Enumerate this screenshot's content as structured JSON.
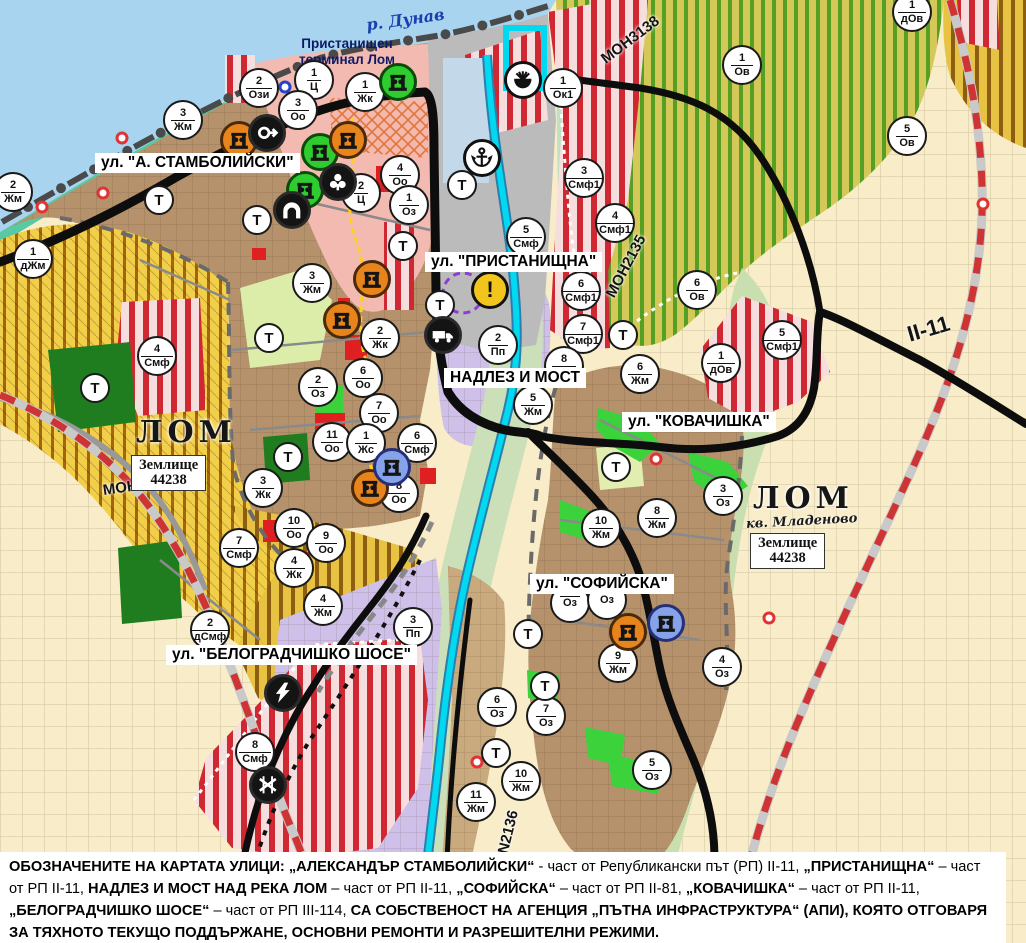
{
  "map": {
    "t_label": "Т",
    "exclamation_label": "!",
    "street_labels": [
      {
        "id": "stambolijski",
        "text": "ул. \"А. СТАМБОЛИЙСКИ\"",
        "x": 95,
        "y": 153
      },
      {
        "id": "pristanishtna",
        "text": "ул. \"ПРИСТАНИЩНА\"",
        "x": 425,
        "y": 252
      },
      {
        "id": "nadlez-i-most",
        "text": "НАДЛЕЗ И МОСТ",
        "x": 444,
        "y": 368
      },
      {
        "id": "kovachishka",
        "text": "ул. \"КОВАЧИШКА\"",
        "x": 622,
        "y": 412
      },
      {
        "id": "sofijska",
        "text": "ул. \"СОФИЙСКА\"",
        "x": 530,
        "y": 574
      },
      {
        "id": "belogradchishko",
        "text": "ул. \"БЕЛОГРАДЧИШКО ШОСЕ\"",
        "x": 166,
        "y": 645
      }
    ],
    "place_labels": [
      {
        "id": "river-danube",
        "cls": "lbl-river",
        "text": "р. Дунав",
        "x": 366,
        "y": 10,
        "rot": -8
      },
      {
        "id": "port-terminal",
        "cls": "lbl-terminal",
        "text": "Пристанищен\nтерминал Лом",
        "x": 262,
        "y": 36,
        "rot": 0
      },
      {
        "id": "city-lom-west",
        "cls": "lbl-city",
        "text": "ЛОМ",
        "x": 136,
        "y": 415,
        "rot": 0
      },
      {
        "id": "city-lom-mladenovo",
        "cls": "lbl-city",
        "text": "ЛОМ",
        "x": 753,
        "y": 481,
        "rot": 0
      },
      {
        "id": "kv-mladenovo",
        "cls": "lbl-district",
        "text": "кв. Младеново",
        "x": 746,
        "y": 514,
        "rot": -3
      },
      {
        "id": "road-mon3139",
        "cls": "lbl-road",
        "text": "МОН3139",
        "x": 103,
        "y": 482,
        "rot": -8
      },
      {
        "id": "road-mon3138",
        "cls": "lbl-road",
        "text": "МОН3138",
        "x": 603,
        "y": 52,
        "rot": -37
      },
      {
        "id": "road-mon2135",
        "cls": "lbl-road",
        "text": "МОН2135",
        "x": 610,
        "y": 288,
        "rot": -62
      },
      {
        "id": "road-mon2136",
        "cls": "lbl-road",
        "text": "N2136",
        "x": 503,
        "y": 845,
        "rot": -76
      },
      {
        "id": "road-ii-11",
        "cls": "lbl-road-big",
        "text": "II-11",
        "x": 908,
        "y": 322,
        "rot": -16
      }
    ],
    "land_boxes": [
      {
        "id": "zemlishte-west",
        "line1": "Землище",
        "line2": "44238",
        "x": 131,
        "y": 455
      },
      {
        "id": "zemlishte-east",
        "line1": "Землище",
        "line2": "44238",
        "x": 750,
        "y": 533
      }
    ],
    "zone_markers": [
      {
        "n": "2",
        "code": "Ози",
        "x": 259,
        "y": 88
      },
      {
        "n": "1",
        "code": "Ц",
        "x": 314,
        "y": 80
      },
      {
        "n": "1",
        "code": "Жк",
        "x": 365,
        "y": 92
      },
      {
        "n": "3",
        "code": "Оо",
        "x": 298,
        "y": 110
      },
      {
        "n": "3",
        "code": "Жм",
        "x": 183,
        "y": 120
      },
      {
        "n": "2",
        "code": "Жм",
        "x": 13,
        "y": 192
      },
      {
        "n": "1",
        "code": "дЖм",
        "x": 33,
        "y": 259
      },
      {
        "n": "4",
        "code": "Оо",
        "x": 400,
        "y": 175
      },
      {
        "n": "2",
        "code": "Ц",
        "x": 361,
        "y": 193
      },
      {
        "n": "1",
        "code": "Оз",
        "x": 409,
        "y": 205
      },
      {
        "n": "5",
        "code": "Смф",
        "x": 526,
        "y": 237
      },
      {
        "n": "3",
        "code": "Смф1",
        "x": 584,
        "y": 178
      },
      {
        "n": "1",
        "code": "Ок1",
        "x": 563,
        "y": 88
      },
      {
        "n": "1",
        "code": "Ов",
        "x": 742,
        "y": 65
      },
      {
        "n": "5",
        "code": "Ов",
        "x": 907,
        "y": 136
      },
      {
        "n": "1",
        "code": "дОв",
        "x": 912,
        "y": 12
      },
      {
        "n": "4",
        "code": "Смф1",
        "x": 615,
        "y": 223
      },
      {
        "n": "6",
        "code": "Ов",
        "x": 697,
        "y": 290
      },
      {
        "n": "6",
        "code": "Смф1",
        "x": 581,
        "y": 291
      },
      {
        "n": "7",
        "code": "Смф1",
        "x": 583,
        "y": 334
      },
      {
        "n": "5",
        "code": "Смф1",
        "x": 782,
        "y": 340
      },
      {
        "n": "1",
        "code": "дОв",
        "x": 721,
        "y": 363
      },
      {
        "n": "6",
        "code": "Жм",
        "x": 640,
        "y": 374
      },
      {
        "n": "8",
        "code": "Жм",
        "x": 564,
        "y": 366
      },
      {
        "n": "5",
        "code": "Жм",
        "x": 533,
        "y": 405
      },
      {
        "n": "3",
        "code": "Жм",
        "x": 312,
        "y": 283
      },
      {
        "n": "2",
        "code": "Жк",
        "x": 380,
        "y": 338
      },
      {
        "n": "2",
        "code": "Оз",
        "x": 318,
        "y": 387
      },
      {
        "n": "6",
        "code": "Оо",
        "x": 363,
        "y": 378
      },
      {
        "n": "7",
        "code": "Оо",
        "x": 379,
        "y": 413
      },
      {
        "n": "11",
        "code": "Оо",
        "x": 332,
        "y": 442
      },
      {
        "n": "1",
        "code": "Жс",
        "x": 366,
        "y": 443
      },
      {
        "n": "6",
        "code": "Смф",
        "x": 417,
        "y": 443
      },
      {
        "n": "8",
        "code": "Оо",
        "x": 399,
        "y": 493
      },
      {
        "n": "3",
        "code": "Жк",
        "x": 263,
        "y": 488
      },
      {
        "n": "4",
        "code": "Смф",
        "x": 157,
        "y": 356
      },
      {
        "n": "10",
        "code": "Оо",
        "x": 294,
        "y": 528
      },
      {
        "n": "9",
        "code": "Оо",
        "x": 326,
        "y": 543
      },
      {
        "n": "4",
        "code": "Жк",
        "x": 294,
        "y": 568
      },
      {
        "n": "4",
        "code": "Жм",
        "x": 323,
        "y": 606
      },
      {
        "n": "7",
        "code": "Смф",
        "x": 239,
        "y": 548
      },
      {
        "n": "2",
        "code": "дСмф",
        "x": 210,
        "y": 630
      },
      {
        "n": "3",
        "code": "Пп",
        "x": 413,
        "y": 627
      },
      {
        "n": "2",
        "code": "Пп",
        "x": 498,
        "y": 345
      },
      {
        "n": "8",
        "code": "Смф",
        "x": 255,
        "y": 752
      },
      {
        "n": "3",
        "code": "Оз",
        "x": 723,
        "y": 496
      },
      {
        "n": "8",
        "code": "Жм",
        "x": 657,
        "y": 518
      },
      {
        "n": "10",
        "code": "Жм",
        "x": 601,
        "y": 528
      },
      {
        "n": "9",
        "code": "Жм",
        "x": 618,
        "y": 663
      },
      {
        "n": "4",
        "code": "Оз",
        "x": 722,
        "y": 667
      },
      {
        "n": "6",
        "code": "Оз",
        "x": 497,
        "y": 707
      },
      {
        "n": "7",
        "code": "Оз",
        "x": 546,
        "y": 716
      },
      {
        "n": "5",
        "code": "Оз",
        "x": 652,
        "y": 770
      },
      {
        "n": "10",
        "code": "Жм",
        "x": 521,
        "y": 781
      },
      {
        "n": "11",
        "code": "Жм",
        "x": 476,
        "y": 802
      },
      {
        "n": "",
        "code": "Оз",
        "x": 570,
        "y": 603
      },
      {
        "n": "",
        "code": "Оз",
        "x": 607,
        "y": 600
      }
    ],
    "t_markers": [
      {
        "x": 159,
        "y": 200
      },
      {
        "x": 257,
        "y": 220
      },
      {
        "x": 269,
        "y": 338
      },
      {
        "x": 95,
        "y": 388
      },
      {
        "x": 288,
        "y": 457
      },
      {
        "x": 403,
        "y": 246
      },
      {
        "x": 440,
        "y": 305
      },
      {
        "x": 462,
        "y": 185
      },
      {
        "x": 623,
        "y": 335
      },
      {
        "x": 616,
        "y": 467
      },
      {
        "x": 528,
        "y": 634
      },
      {
        "x": 545,
        "y": 686
      },
      {
        "x": 496,
        "y": 753
      }
    ],
    "icon_markers": [
      {
        "icon": "monument-icon",
        "variant": "green",
        "x": 398,
        "y": 82
      },
      {
        "icon": "monument-icon",
        "variant": "green",
        "x": 320,
        "y": 152
      },
      {
        "icon": "monument-icon",
        "variant": "green",
        "x": 305,
        "y": 190
      },
      {
        "icon": "monument-icon",
        "variant": "orange",
        "x": 239,
        "y": 140
      },
      {
        "icon": "monument-icon",
        "variant": "orange",
        "x": 348,
        "y": 140
      },
      {
        "icon": "monument-icon",
        "variant": "orange",
        "x": 372,
        "y": 279
      },
      {
        "icon": "monument-icon",
        "variant": "orange",
        "x": 342,
        "y": 320
      },
      {
        "icon": "monument-icon",
        "variant": "orange",
        "x": 370,
        "y": 488
      },
      {
        "icon": "monument-icon",
        "variant": "orange",
        "x": 628,
        "y": 632
      },
      {
        "icon": "monument-icon",
        "variant": "blue",
        "x": 392,
        "y": 467
      },
      {
        "icon": "monument-icon",
        "variant": "blue",
        "x": 666,
        "y": 623
      },
      {
        "icon": "key-icon",
        "variant": "black",
        "x": 267,
        "y": 133
      },
      {
        "icon": "trefoil-icon",
        "variant": "black",
        "x": 338,
        "y": 182
      },
      {
        "icon": "arch-icon",
        "variant": "black",
        "x": 292,
        "y": 210
      },
      {
        "icon": "anchor-icon",
        "variant": "white",
        "x": 482,
        "y": 158
      },
      {
        "icon": "sunburst-icon",
        "variant": "white",
        "x": 523,
        "y": 80
      },
      {
        "icon": "truck-icon",
        "variant": "black",
        "x": 443,
        "y": 335
      },
      {
        "icon": "lightning-icon",
        "variant": "black",
        "x": 283,
        "y": 693
      },
      {
        "icon": "railway-crossing-icon",
        "variant": "black",
        "x": 268,
        "y": 785
      },
      {
        "icon": "exclamation-icon",
        "variant": "yellow",
        "x": 490,
        "y": 290
      }
    ],
    "dot_markers": [
      {
        "x": 122,
        "y": 138,
        "color": "red"
      },
      {
        "x": 103,
        "y": 193,
        "color": "red"
      },
      {
        "x": 42,
        "y": 207,
        "color": "red"
      },
      {
        "x": 656,
        "y": 459,
        "color": "red"
      },
      {
        "x": 769,
        "y": 618,
        "color": "red"
      },
      {
        "x": 983,
        "y": 204,
        "color": "red"
      },
      {
        "x": 477,
        "y": 762,
        "color": "red"
      },
      {
        "x": 285,
        "y": 87,
        "color": "blue"
      }
    ],
    "note_segments": [
      {
        "bold": true,
        "text": "ОБОЗНАЧЕНИТЕ НА КАРТАТА УЛИЦИ: „АЛЕКСАНДЪР СТАМБОЛИЙСКИ“"
      },
      {
        "bold": false,
        "text": " - част от Републикански път (РП) II-11, "
      },
      {
        "bold": true,
        "text": "„ПРИСТАНИЩНА“"
      },
      {
        "bold": false,
        "text": " – част от РП II-11, "
      },
      {
        "bold": true,
        "text": "НАДЛЕЗ И МОСТ НАД РЕКА ЛОМ"
      },
      {
        "bold": false,
        "text": " – част от РП II-11, "
      },
      {
        "bold": true,
        "text": "„СОФИЙСКА“"
      },
      {
        "bold": false,
        "text": " – част от РП II-81, "
      },
      {
        "bold": true,
        "text": "„КОВАЧИШКА“"
      },
      {
        "bold": false,
        "text": " – част от РП II-11, "
      },
      {
        "bold": true,
        "text": "„БЕЛОГРАДЧИШКО ШОСЕ“"
      },
      {
        "bold": false,
        "text": " – част от РП III-114, "
      },
      {
        "bold": true,
        "text": "СА СОБСТВЕНОСТ НА АГЕНЦИЯ „ПЪТНА ИНФРАСТРУКТУРА“ (АПИ), КОЯТО ОТГОВАРЯ ЗА ТЯХНОТО ТЕКУЩО ПОДДЪРЖАНЕ, ОСНОВНИ РЕМОНТИ И РАЗРЕШИТЕЛНИ РЕЖИМИ."
      }
    ]
  }
}
